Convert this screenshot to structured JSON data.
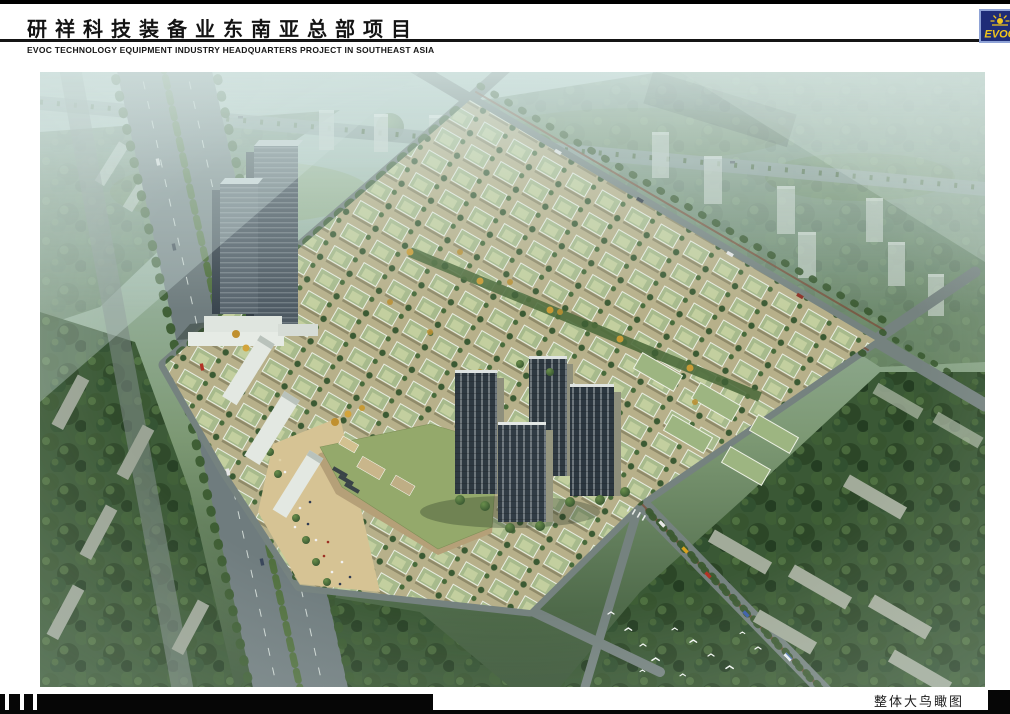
{
  "header": {
    "title": "研祥科技装备业东南亚总部项目",
    "subtitle": "EVOC TECHNOLOGY EQUIPMENT INDUSTRY HEADQUARTERS PROJECT IN SOUTHEAST ASIA"
  },
  "logo": {
    "text": "EVOC",
    "colors": {
      "background": "#1e2c77",
      "border": "#8fa3d6",
      "accent": "#f1c51c"
    }
  },
  "footer": {
    "caption": "整体大鸟瞰图"
  },
  "rendering": {
    "description": "Aerial bird's-eye rendering of the EVOC technology industrial park: a central campus of low-rise green-roofed workshop villas, twin dark office towers at the north-west corner, a commercial podium with a large green roof and pedestrian plaza, four dark residential high-rises, all ringed by tree-lined boulevards, slab apartment blocks in dense forest and hazy distant city",
    "palette": {
      "haze": "#c2d6cf",
      "forest": "#2f4c2b",
      "lawn": "#7fa05e",
      "road": "#75827f",
      "site_ground": "#b7b08a",
      "villa_roof": "#a7ba8c",
      "plaza": "#d6c394",
      "office_tower": "#4e5a63",
      "residential_tower": "#2e3941",
      "autumn_tree": "#c79a35",
      "sidewalk_edge": "#7a503c"
    }
  }
}
